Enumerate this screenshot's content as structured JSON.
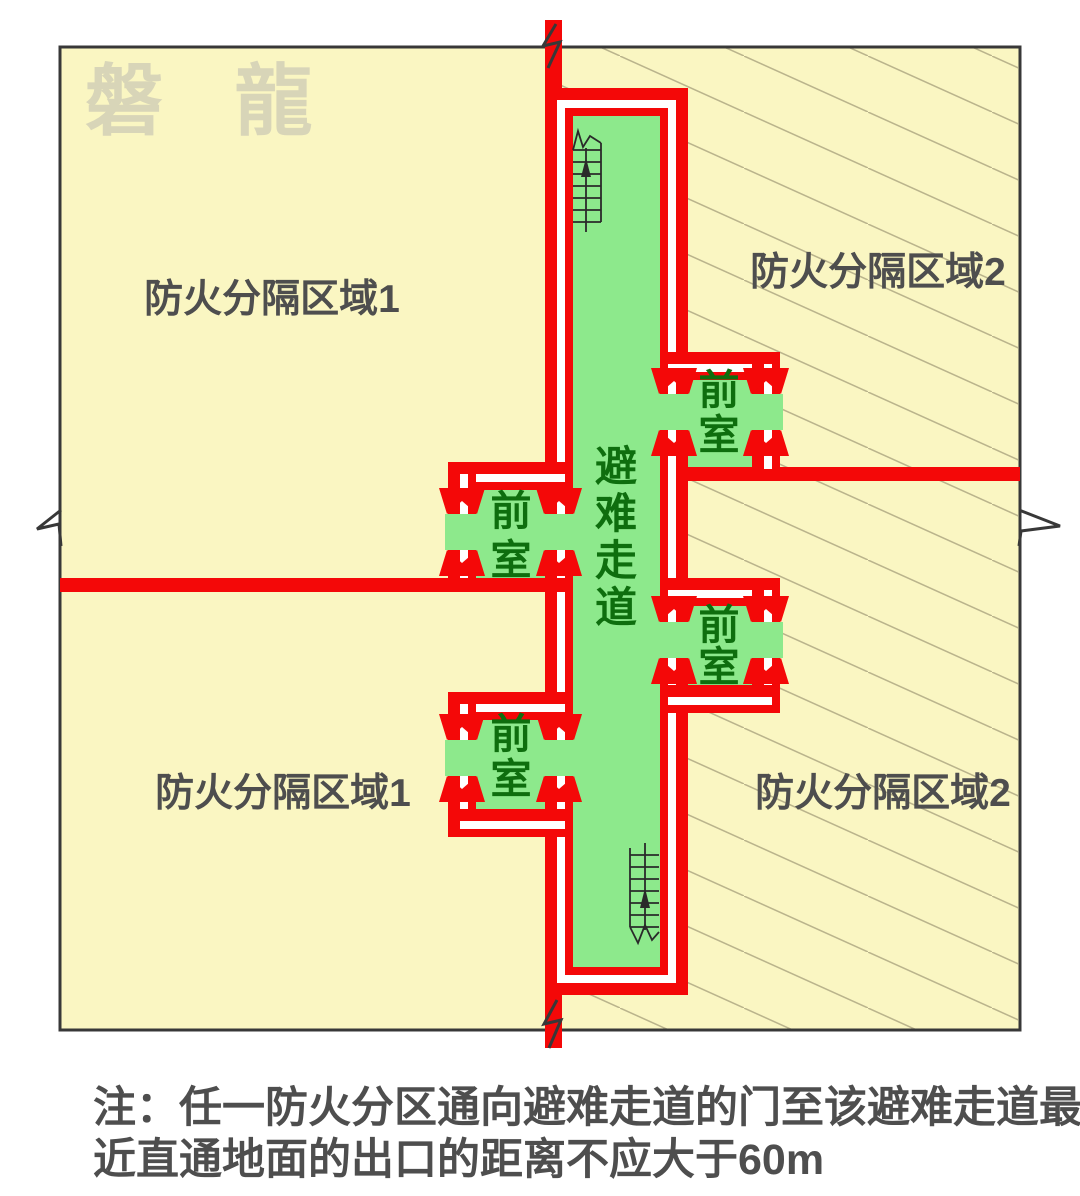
{
  "title": "避难走道防火分隔示意图",
  "colors": {
    "page_bg": "#FFFFFF",
    "cream": "#FAF6C2",
    "green": "#8DE98C",
    "red": "#F40808",
    "wall_white": "#FFFFFF",
    "dark_green": "#0E6E0E",
    "text_gray": "#4E4E4E",
    "hatch": "#BAB48C",
    "border": "#383838",
    "stair": "#2A2A2A",
    "watermark": "#D8D5B8"
  },
  "watermark": "磐 龍",
  "zones": {
    "zone1_label": "防火分隔区域1",
    "zone2_label": "防火分隔区域2"
  },
  "corridor": {
    "label": "避难走道",
    "chars": [
      "避",
      "难",
      "走",
      "道"
    ]
  },
  "anteroom": {
    "label": "前室",
    "chars": [
      "前",
      "室"
    ]
  },
  "note": {
    "line1": "注：任一防火分区通向避难走道的门至该避难走道最",
    "line2": "近直通地面的出口的距离不应大于60m"
  }
}
